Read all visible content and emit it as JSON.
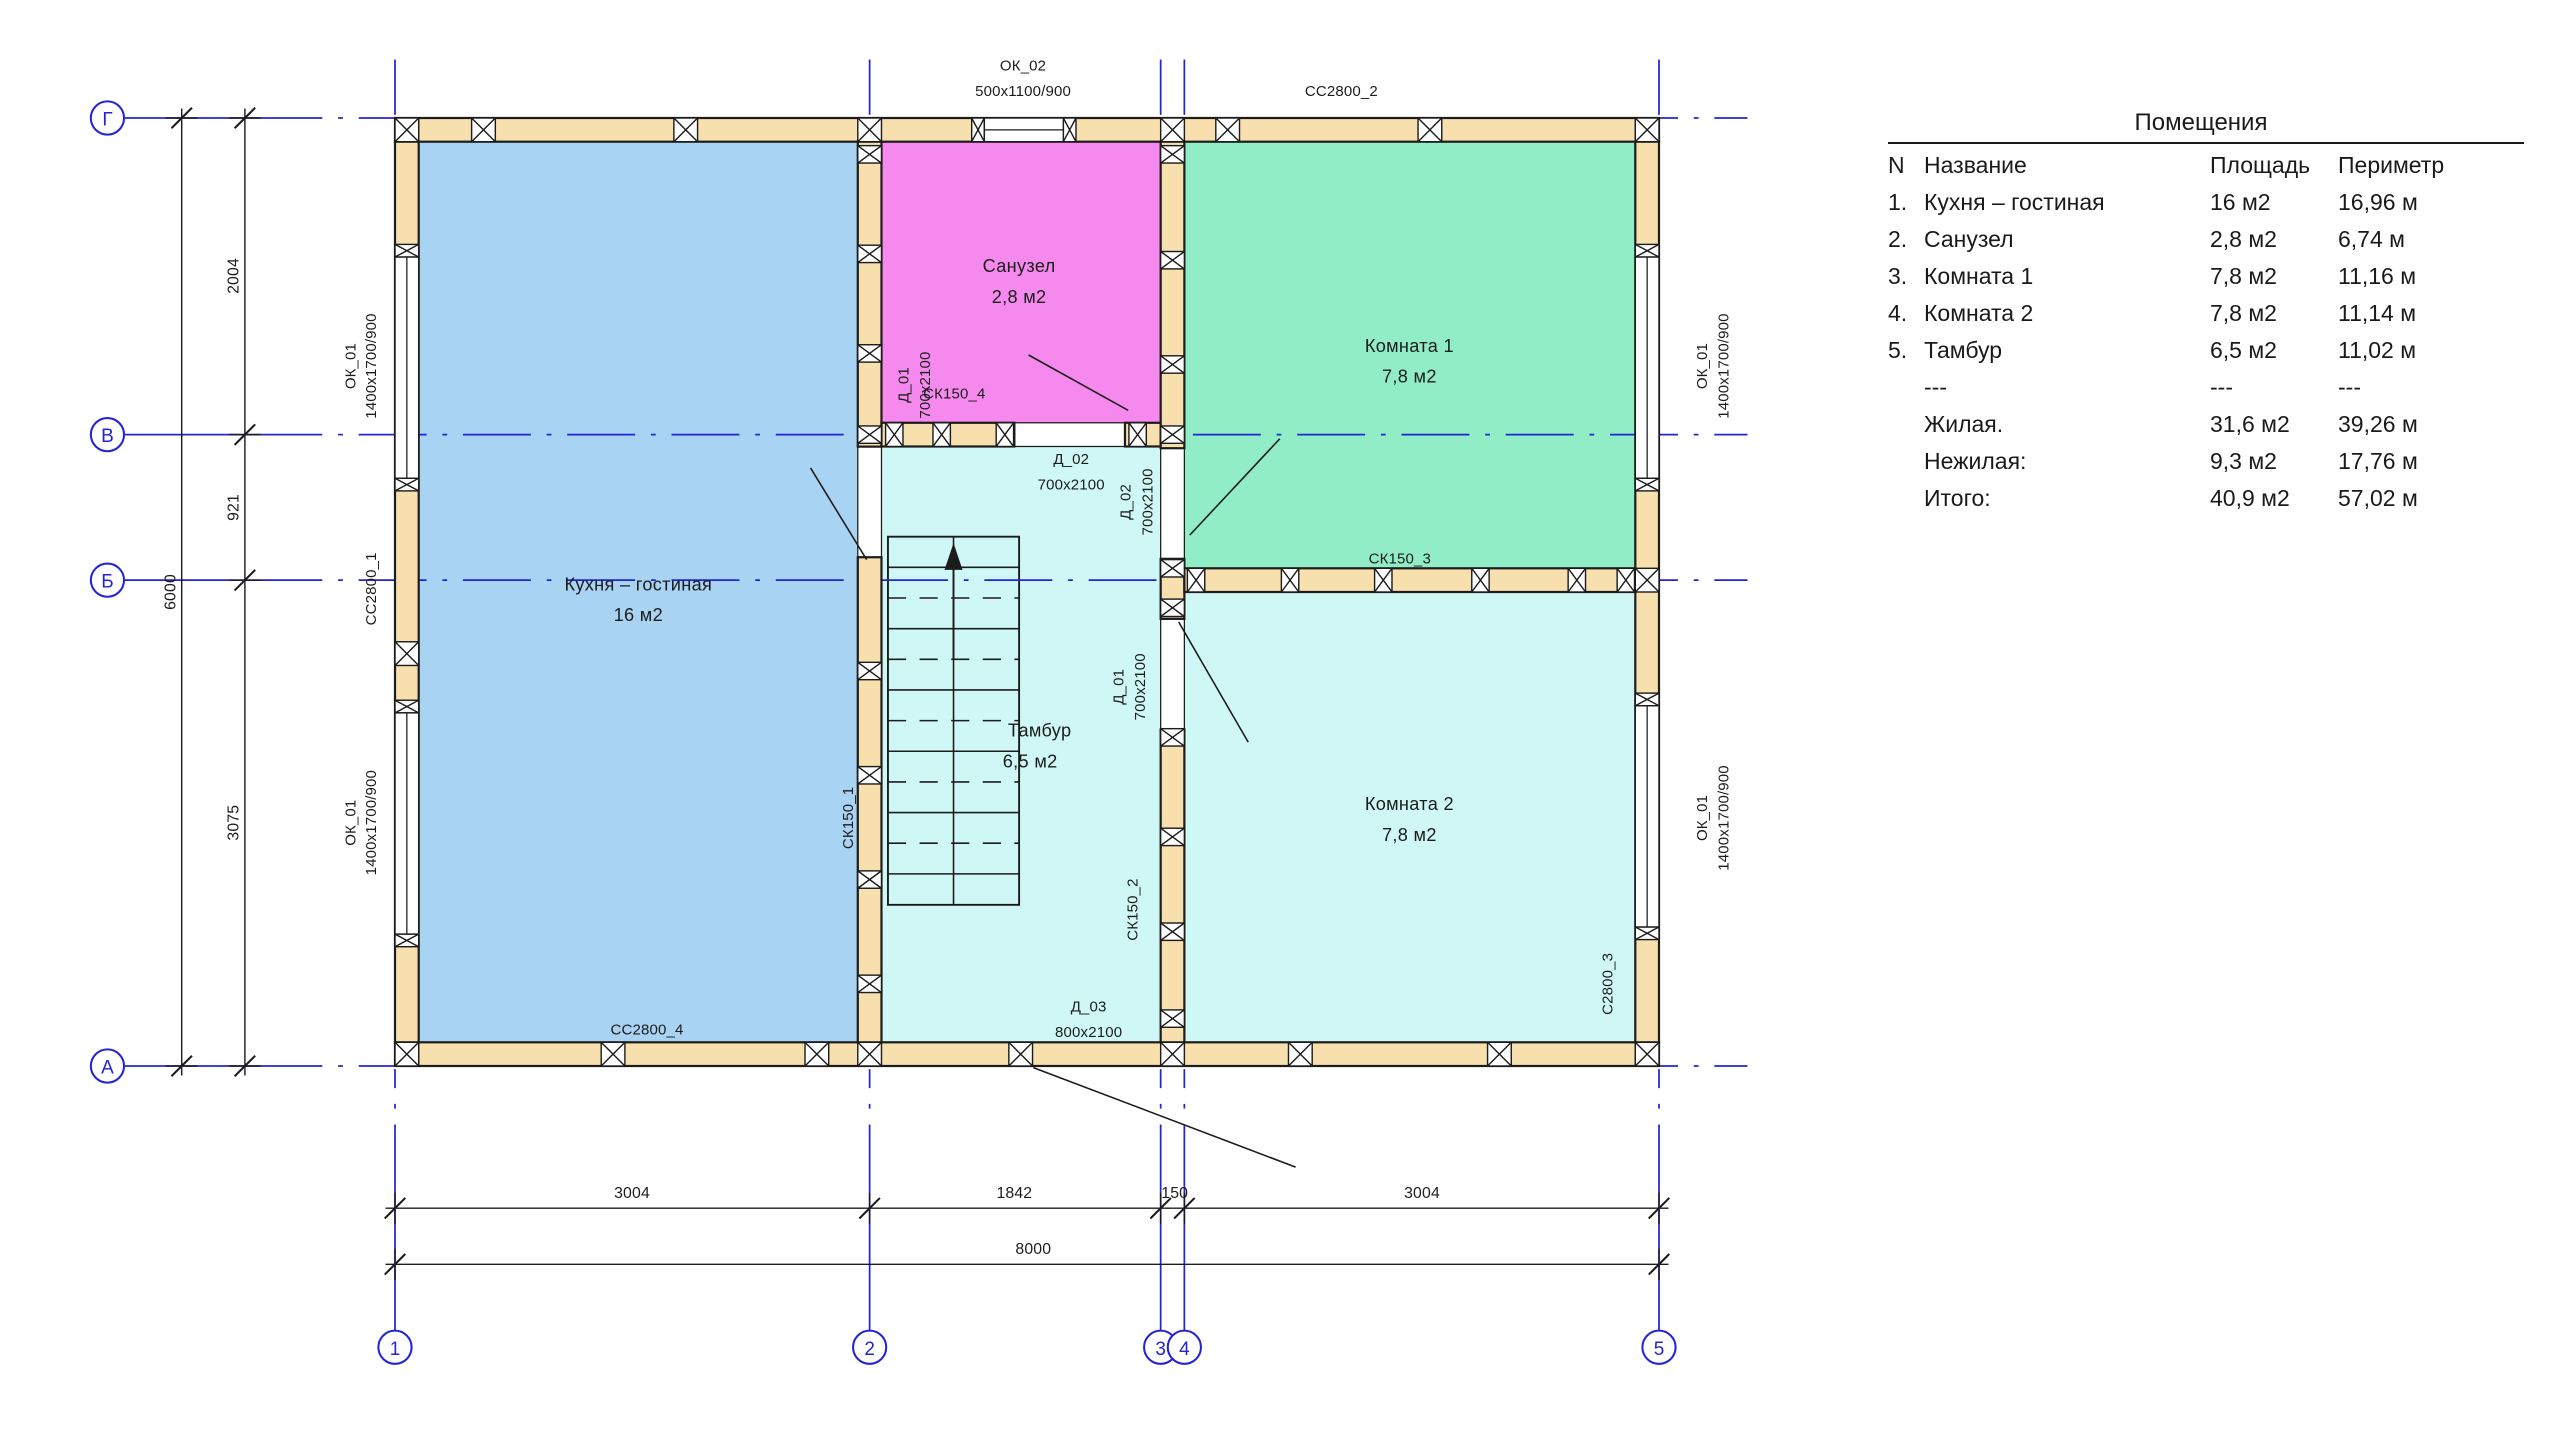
{
  "table": {
    "title": "Помещения",
    "headers": [
      "N",
      "Название",
      "Площадь",
      "Периметр"
    ],
    "rows": [
      {
        "n": "1.",
        "name": "Кухня – гостиная",
        "area": "16 м2",
        "perimeter": "16,96 м"
      },
      {
        "n": "2.",
        "name": "Санузел",
        "area": "2,8 м2",
        "perimeter": "6,74 м"
      },
      {
        "n": "3.",
        "name": "Комната 1",
        "area": "7,8 м2",
        "perimeter": "11,16 м"
      },
      {
        "n": "4.",
        "name": "Комната 2",
        "area": "7,8 м2",
        "perimeter": "11,14 м"
      },
      {
        "n": "5.",
        "name": "Тамбур",
        "area": "6,5 м2",
        "perimeter": "11,02 м"
      },
      {
        "n": "",
        "name": "---",
        "area": "---",
        "perimeter": "---"
      },
      {
        "n": "",
        "name": "Жилая.",
        "area": "31,6 м2",
        "perimeter": "39,26 м"
      },
      {
        "n": "",
        "name": "Нежилая:",
        "area": "9,3 м2",
        "perimeter": "17,76 м"
      },
      {
        "n": "",
        "name": "Итого:",
        "area": "40,9 м2",
        "perimeter": "57,02 м"
      }
    ]
  },
  "rooms": [
    {
      "name": "Кухня – гостиная",
      "area": "16 м2"
    },
    {
      "name": "Санузел",
      "area": "2,8 м2"
    },
    {
      "name": "Комната 1",
      "area": "7,8 м2"
    },
    {
      "name": "Комната 2",
      "area": "7,8 м2"
    },
    {
      "name": "Тамбур",
      "area": "6,5 м2"
    }
  ],
  "plan": {
    "windows": {
      "ok01": {
        "name": "ОК_01",
        "size": "1400х1700/900"
      },
      "ok02": {
        "name": "ОК_02",
        "size": "500х1100/900"
      }
    },
    "doors": {
      "d01": {
        "name": "Д_01",
        "size": "700х2100"
      },
      "d02": {
        "name": "Д_02",
        "size": "700х2100"
      },
      "d03": {
        "name": "Д_03",
        "size": "800х2100"
      }
    },
    "walls": {
      "cc2800_1": "СС2800_1",
      "cc2800_2": "СС2800_2",
      "c2800_3": "С2800_3",
      "cc2800_4": "СС2800_4",
      "ck150_1": "СК150_1",
      "ck150_2": "СК150_2",
      "ck150_3": "СК150_3",
      "ck150_4": "СК150_4"
    }
  },
  "axes": {
    "left": [
      "Г",
      "В",
      "Б",
      "А"
    ],
    "bottom": [
      "1",
      "2",
      "3",
      "4",
      "5"
    ]
  },
  "dimensions": {
    "left_segments": [
      "2004",
      "921",
      "3075"
    ],
    "left_total": "6000",
    "bottom_segments": [
      "3004",
      "1842",
      "150",
      "3004"
    ],
    "bottom_total": "8000"
  },
  "colors": {
    "axis_blue": "#2424d6",
    "wall_fill": "#f8dfae",
    "room_blue": "#a8d3f3",
    "room_pink": "#f689ee",
    "room_green": "#90edc5",
    "room_cyan": "#cef7f6",
    "line_black": "#1c1c1c",
    "white": "#ffffff"
  }
}
